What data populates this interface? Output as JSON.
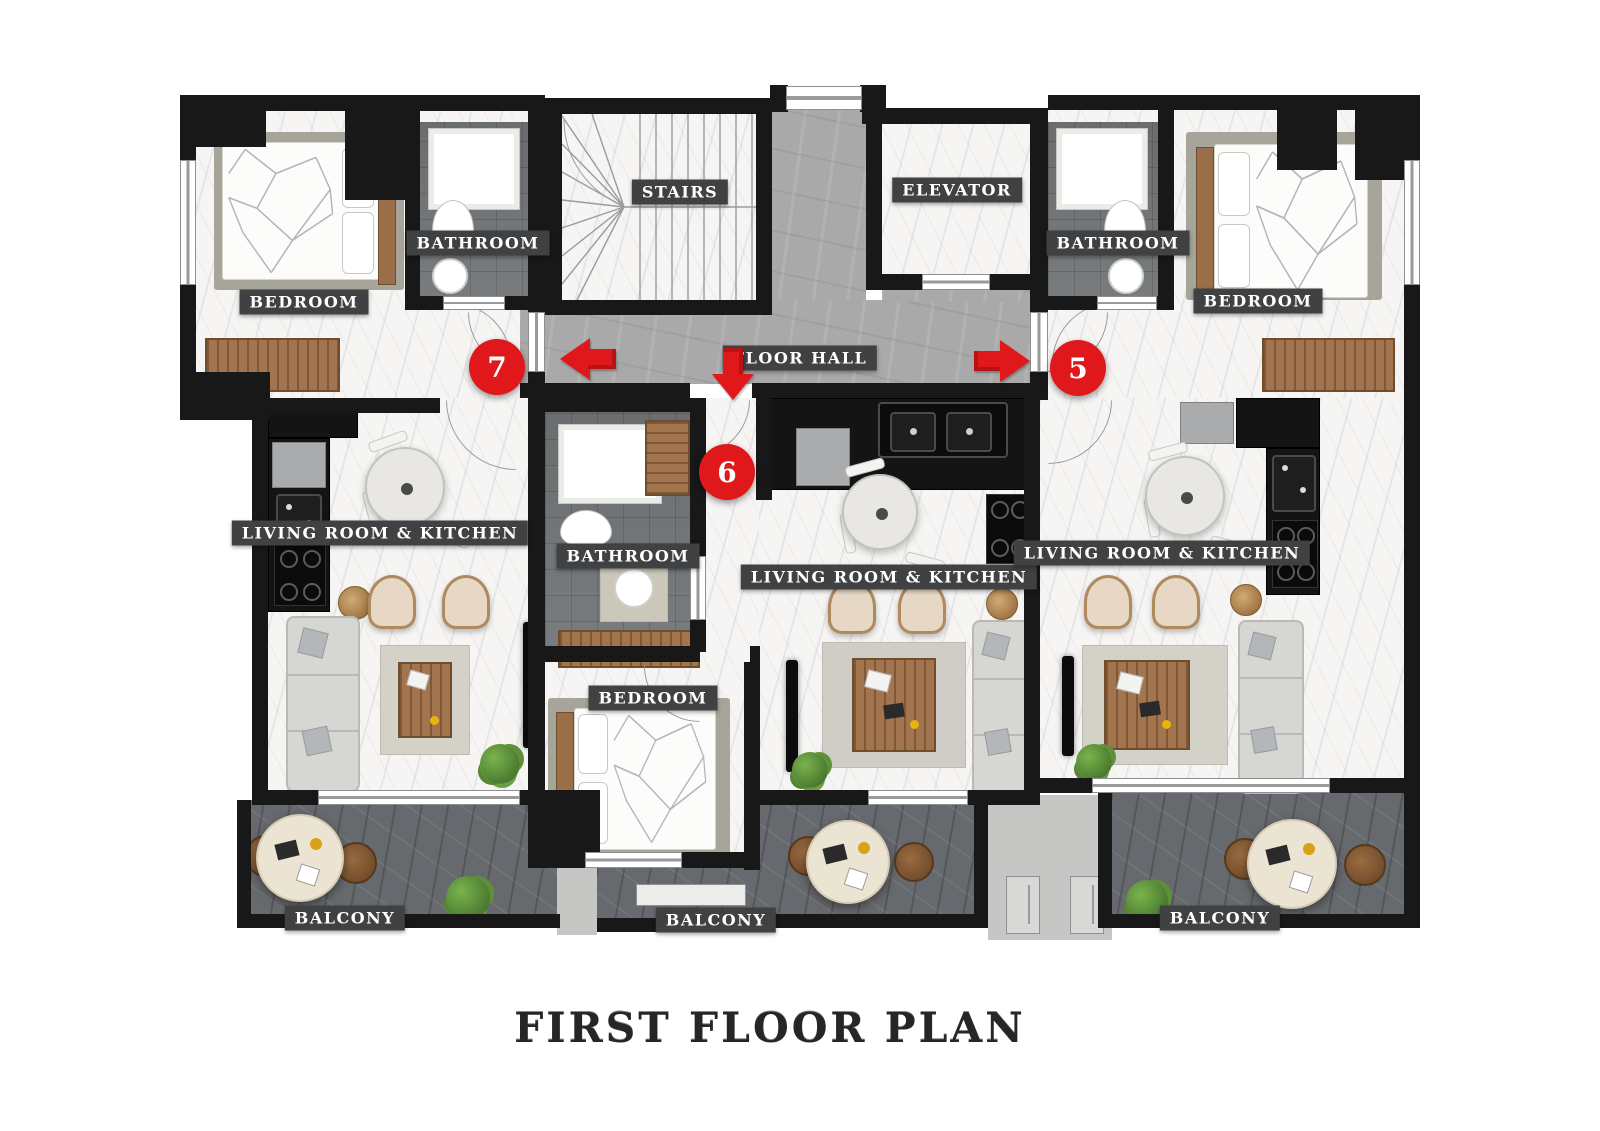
{
  "title": "FIRST FLOOR PLAN",
  "colors": {
    "accent_red": "#e0181c",
    "wall_black": "#181818",
    "label_background": "#3f4142",
    "hall_floor_gray": "#a9a9a9",
    "balcony_floor_gray": "#66696d",
    "marble_floor": "#f6f5f3"
  },
  "rooms": {
    "bedroom_left": "BEDROOM",
    "bathroom_left": "BATHROOM",
    "stairs": "STAIRS",
    "elevator": "ELEVATOR",
    "bathroom_right": "BATHROOM",
    "bedroom_right": "BEDROOM",
    "floor_hall": "FLOOR HALL",
    "living_left": "LIVING ROOM & KITCHEN",
    "bathroom_middle": "BATHROOM",
    "living_middle": "LIVING ROOM & KITCHEN",
    "living_right": "LIVING ROOM & KITCHEN",
    "bedroom_middle": "BEDROOM",
    "balcony_left": "BALCONY",
    "balcony_middle": "BALCONY",
    "balcony_right": "BALCONY"
  },
  "unit_badges": {
    "left": "7",
    "middle": "6",
    "right": "5"
  },
  "icons": {
    "left_unit_arrow": "arrow-left",
    "middle_unit_arrow": "arrow-down",
    "right_unit_arrow": "arrow-right"
  }
}
